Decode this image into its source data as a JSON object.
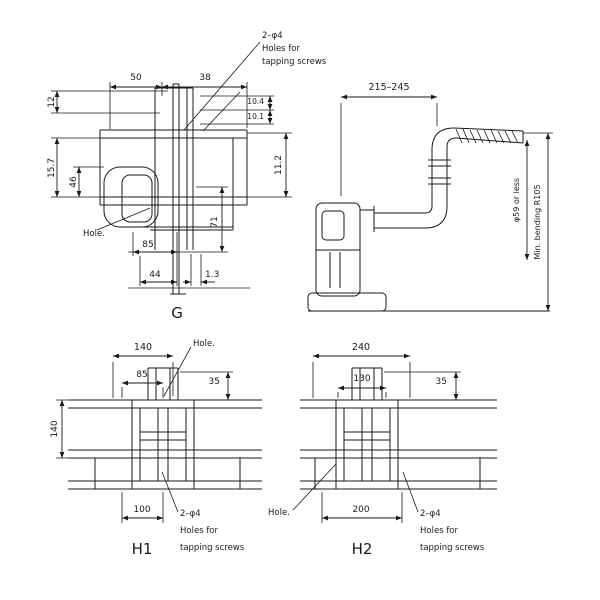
{
  "drawing": {
    "title": "dimensional-outline-drawing",
    "colors": {
      "background": "#ffffff",
      "line": "#1a1a1a"
    },
    "tap_note": {
      "l1": "2–φ4",
      "l2": "Holes for",
      "l3": "tapping screws"
    },
    "hole_label": "Hole.",
    "views": {
      "g": {
        "label": "G",
        "dims": {
          "d50": "50",
          "d38": "38",
          "d12": "12",
          "d157": "15.7",
          "d46": "46",
          "d104": "10.4",
          "d101": "10.1",
          "d71": "71",
          "d112": "11.2",
          "d85": "85",
          "d44": "44",
          "d13": "1.3"
        }
      },
      "side": {
        "dims": {
          "span": "215–245",
          "inner": "φ59 or less",
          "outer": "Min. bending R105"
        }
      },
      "h1": {
        "label": "H1",
        "dims": {
          "w": "140",
          "iw": "85",
          "s": "35",
          "h": "140",
          "b": "100"
        }
      },
      "h2": {
        "label": "H2",
        "dims": {
          "w": "240",
          "iw": "130",
          "s": "35",
          "b": "200"
        }
      }
    }
  }
}
